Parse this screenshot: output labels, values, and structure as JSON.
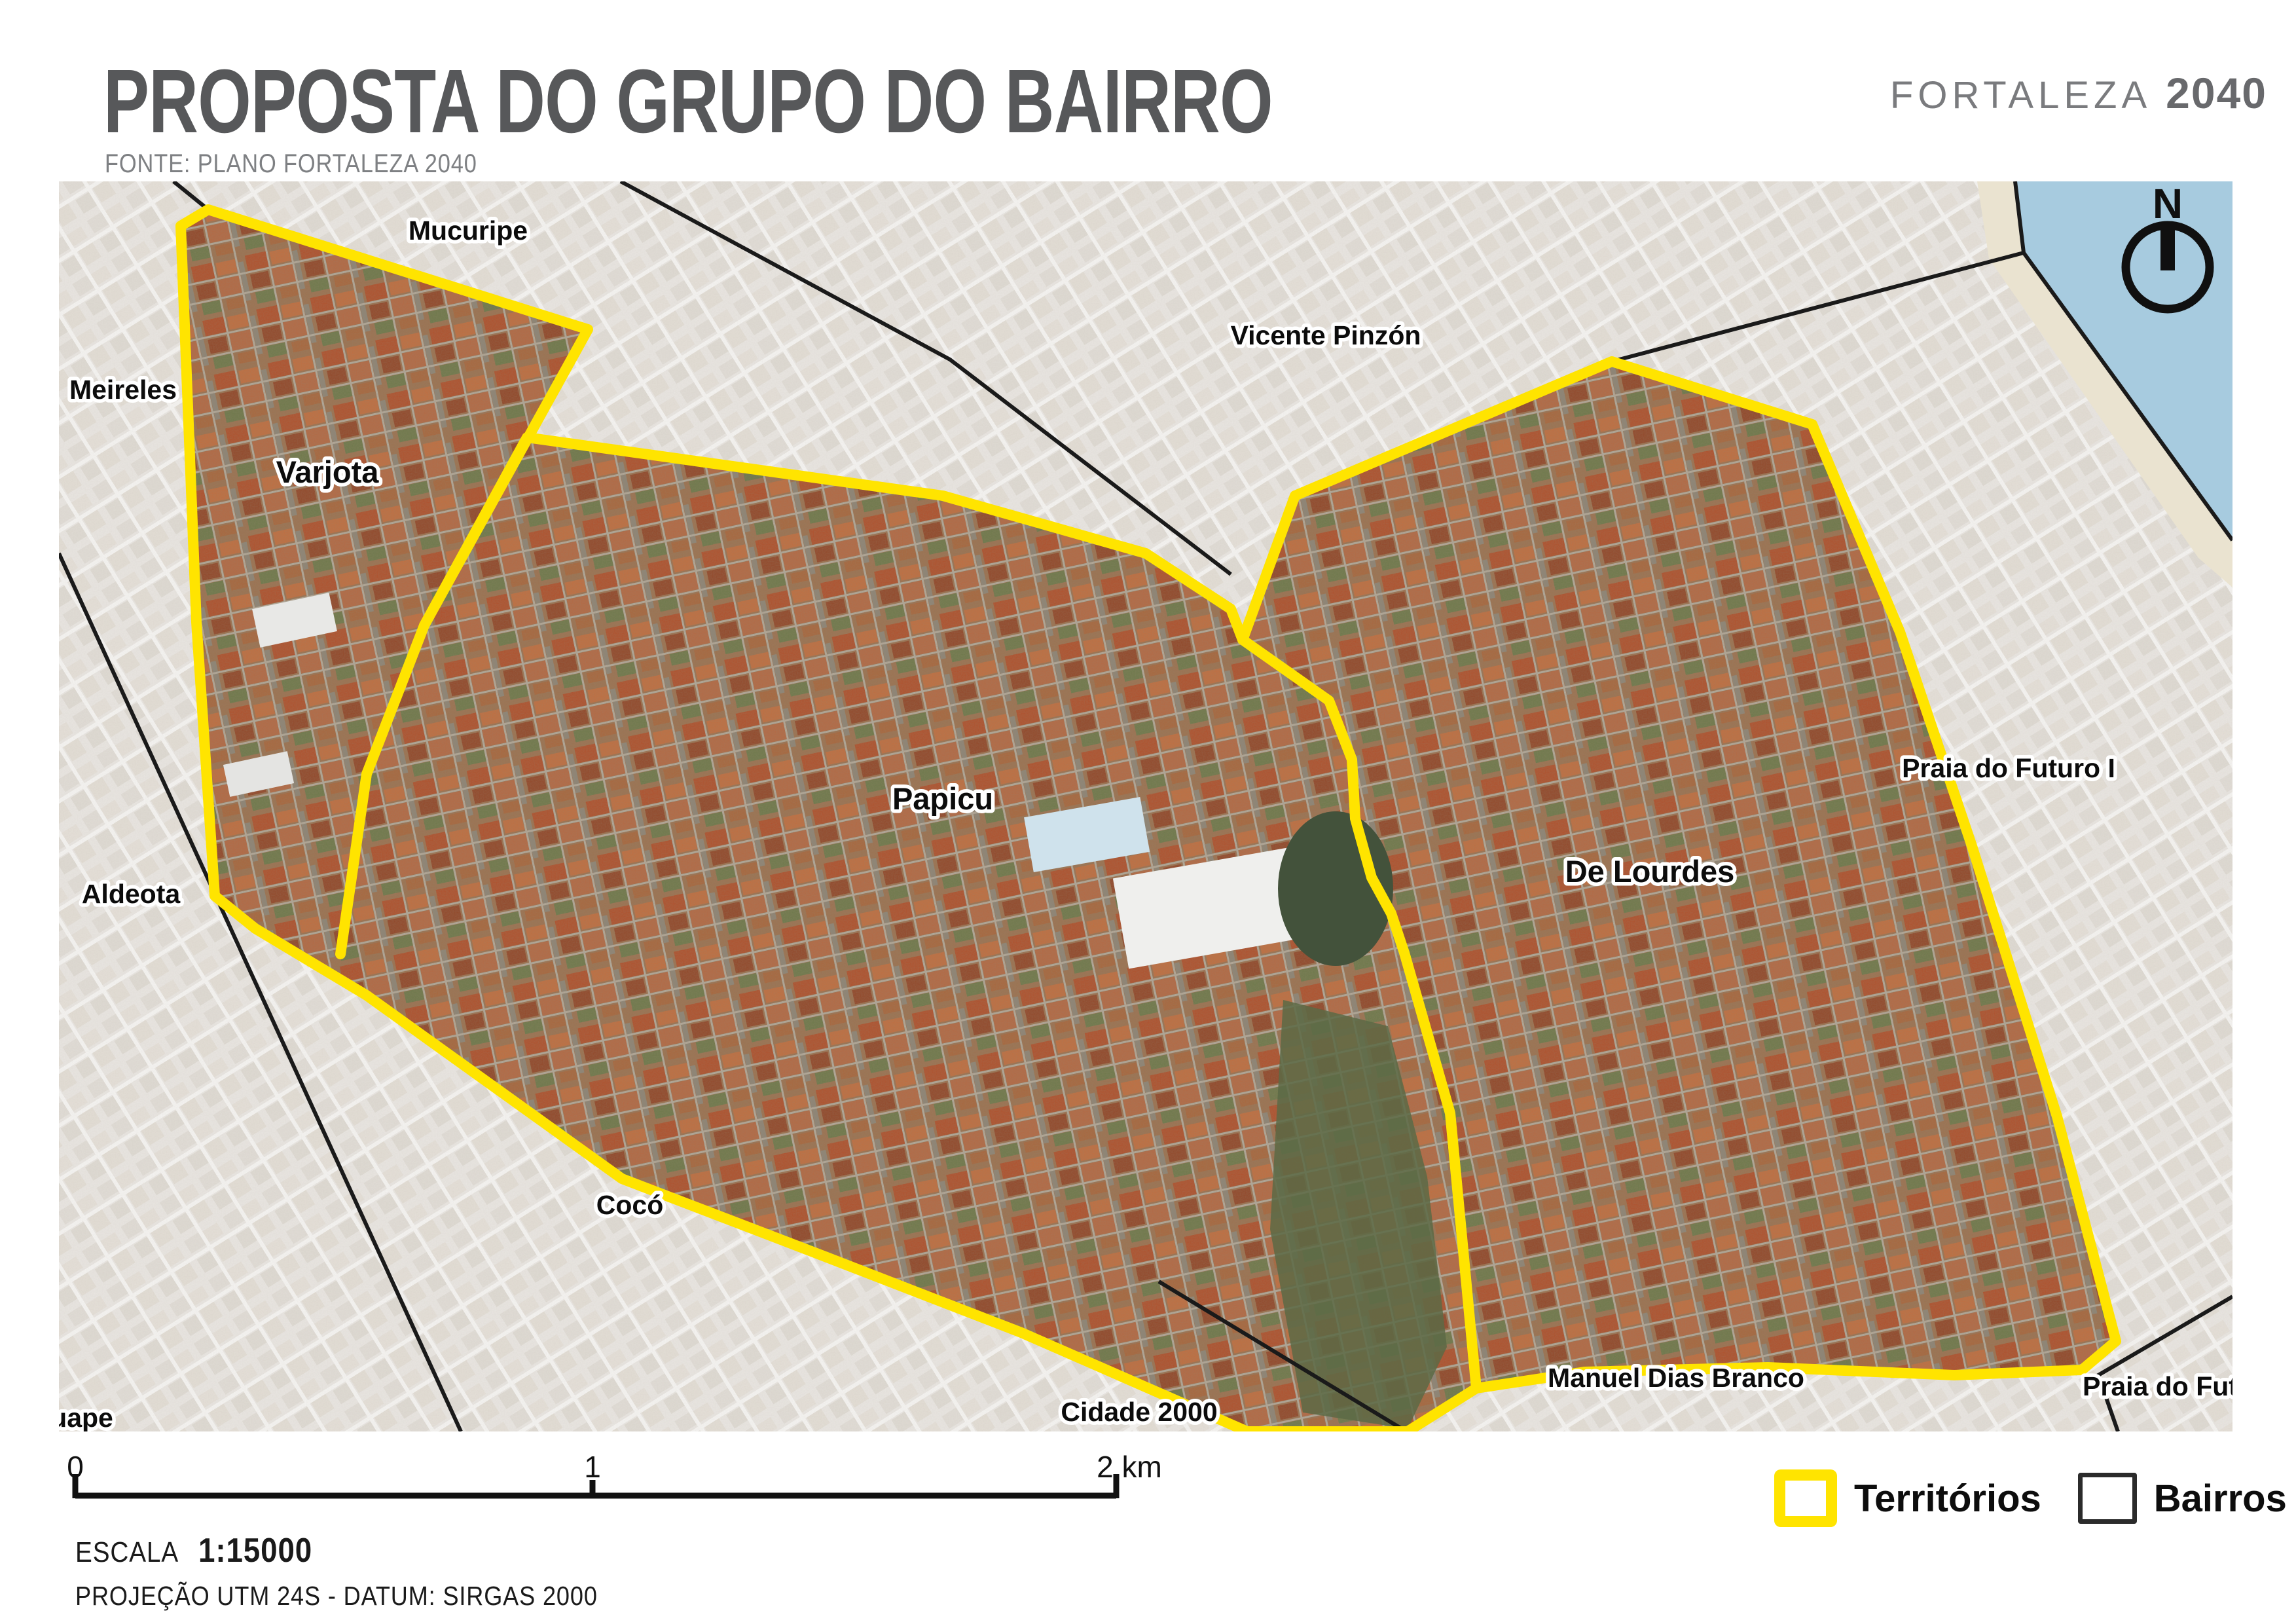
{
  "header": {
    "title": "PROPOSTA DO GRUPO DO BAIRRO",
    "source": "FONTE: PLANO FORTALEZA 2040",
    "brand_name": "FORTALEZA",
    "brand_year": "2040"
  },
  "map": {
    "north_label": "N",
    "outside_labels": [
      {
        "id": "mucuripe",
        "text": "Mucuripe"
      },
      {
        "id": "meireles",
        "text": "Meireles"
      },
      {
        "id": "vicente-pinzon",
        "text": "Vicente Pinzón"
      },
      {
        "id": "aldeota",
        "text": "Aldeota"
      },
      {
        "id": "praia-do-futuro-i",
        "text": "Praia do Futuro I"
      },
      {
        "id": "coco",
        "text": "Cocó"
      },
      {
        "id": "cidade-2000",
        "text": "Cidade 2000"
      },
      {
        "id": "manuel-dias-branco",
        "text": "Manuel Dias Branco"
      },
      {
        "id": "praia-do-futuro-clipped",
        "text": "Praia do Futur"
      },
      {
        "id": "uape-clipped",
        "text": "uape"
      }
    ],
    "territory_labels": [
      {
        "id": "varjota",
        "text": "Varjota"
      },
      {
        "id": "papicu",
        "text": "Papicu"
      },
      {
        "id": "de-lourdes",
        "text": "De Lourdes"
      }
    ],
    "colors": {
      "territory_outline": "#FFE400",
      "water": "#A7CBDF",
      "boundary_line": "#1A1A1A",
      "faded_land": "#E8E5E1"
    }
  },
  "scalebar": {
    "tick_0": "0",
    "tick_1": "1",
    "tick_2": "2 km"
  },
  "footer": {
    "scale_label": "ESCALA",
    "scale_value": "1:15000",
    "projection": "PROJEÇÃO UTM 24S - DATUM: SIRGAS 2000"
  },
  "legend": {
    "territories_label": "Territórios",
    "bairros_label": "Bairros"
  }
}
